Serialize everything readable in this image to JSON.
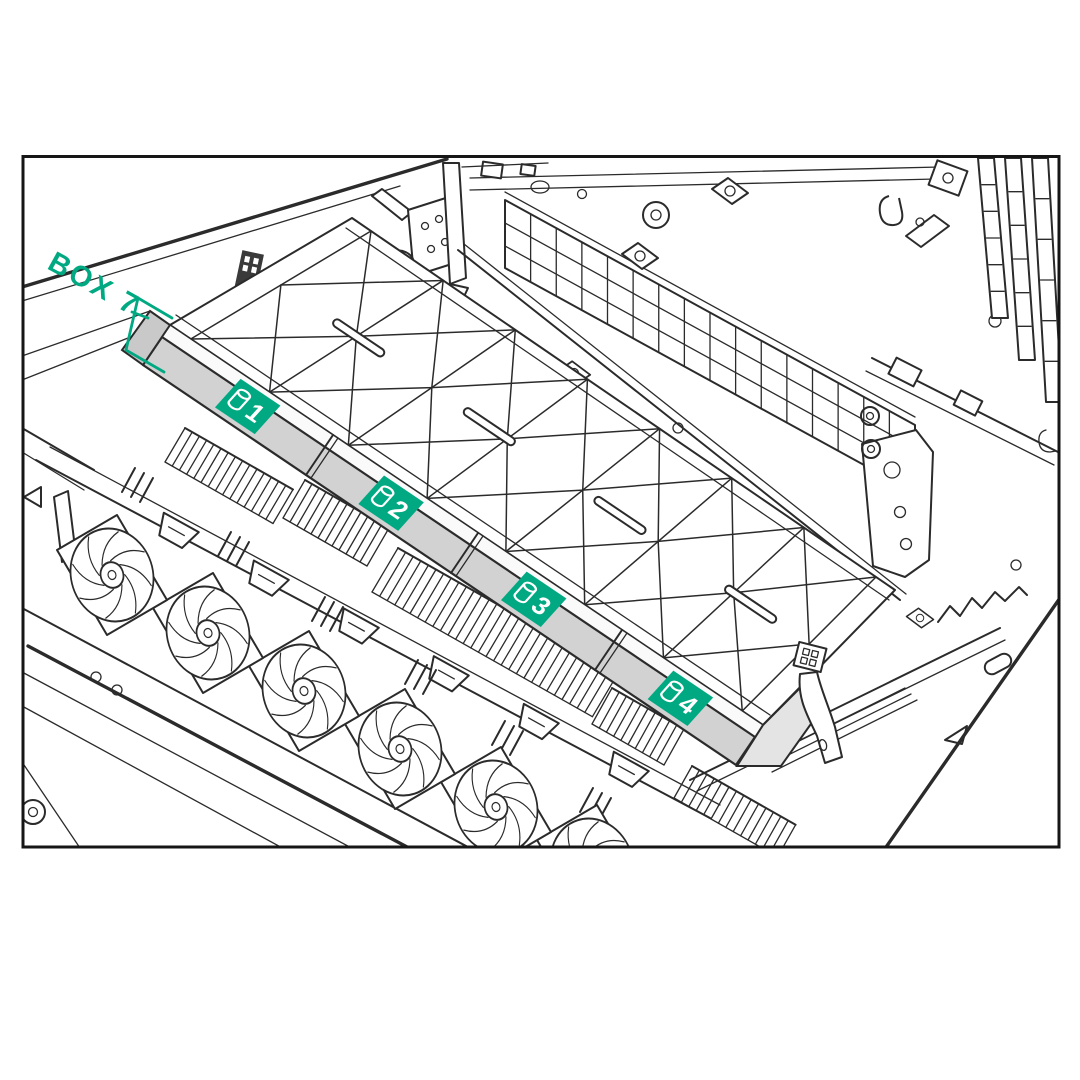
{
  "figure": {
    "type": "technical-illustration",
    "subject": "Server chassis interior, top isometric view, Box 7 drive-cage location callout",
    "annotation": {
      "label": "BOX 7"
    },
    "badges": [
      {
        "label": "1",
        "icon": "drive-icon"
      },
      {
        "label": "2",
        "icon": "drive-icon"
      },
      {
        "label": "3",
        "icon": "drive-icon"
      },
      {
        "label": "4",
        "icon": "drive-icon"
      }
    ],
    "colors": {
      "background": "#ffffff",
      "frame": "#161616",
      "line": "#2b2b2b",
      "cage_fill": "#d2d2d2",
      "accent_green": "#01a982",
      "badge_text": "#ffffff"
    }
  }
}
